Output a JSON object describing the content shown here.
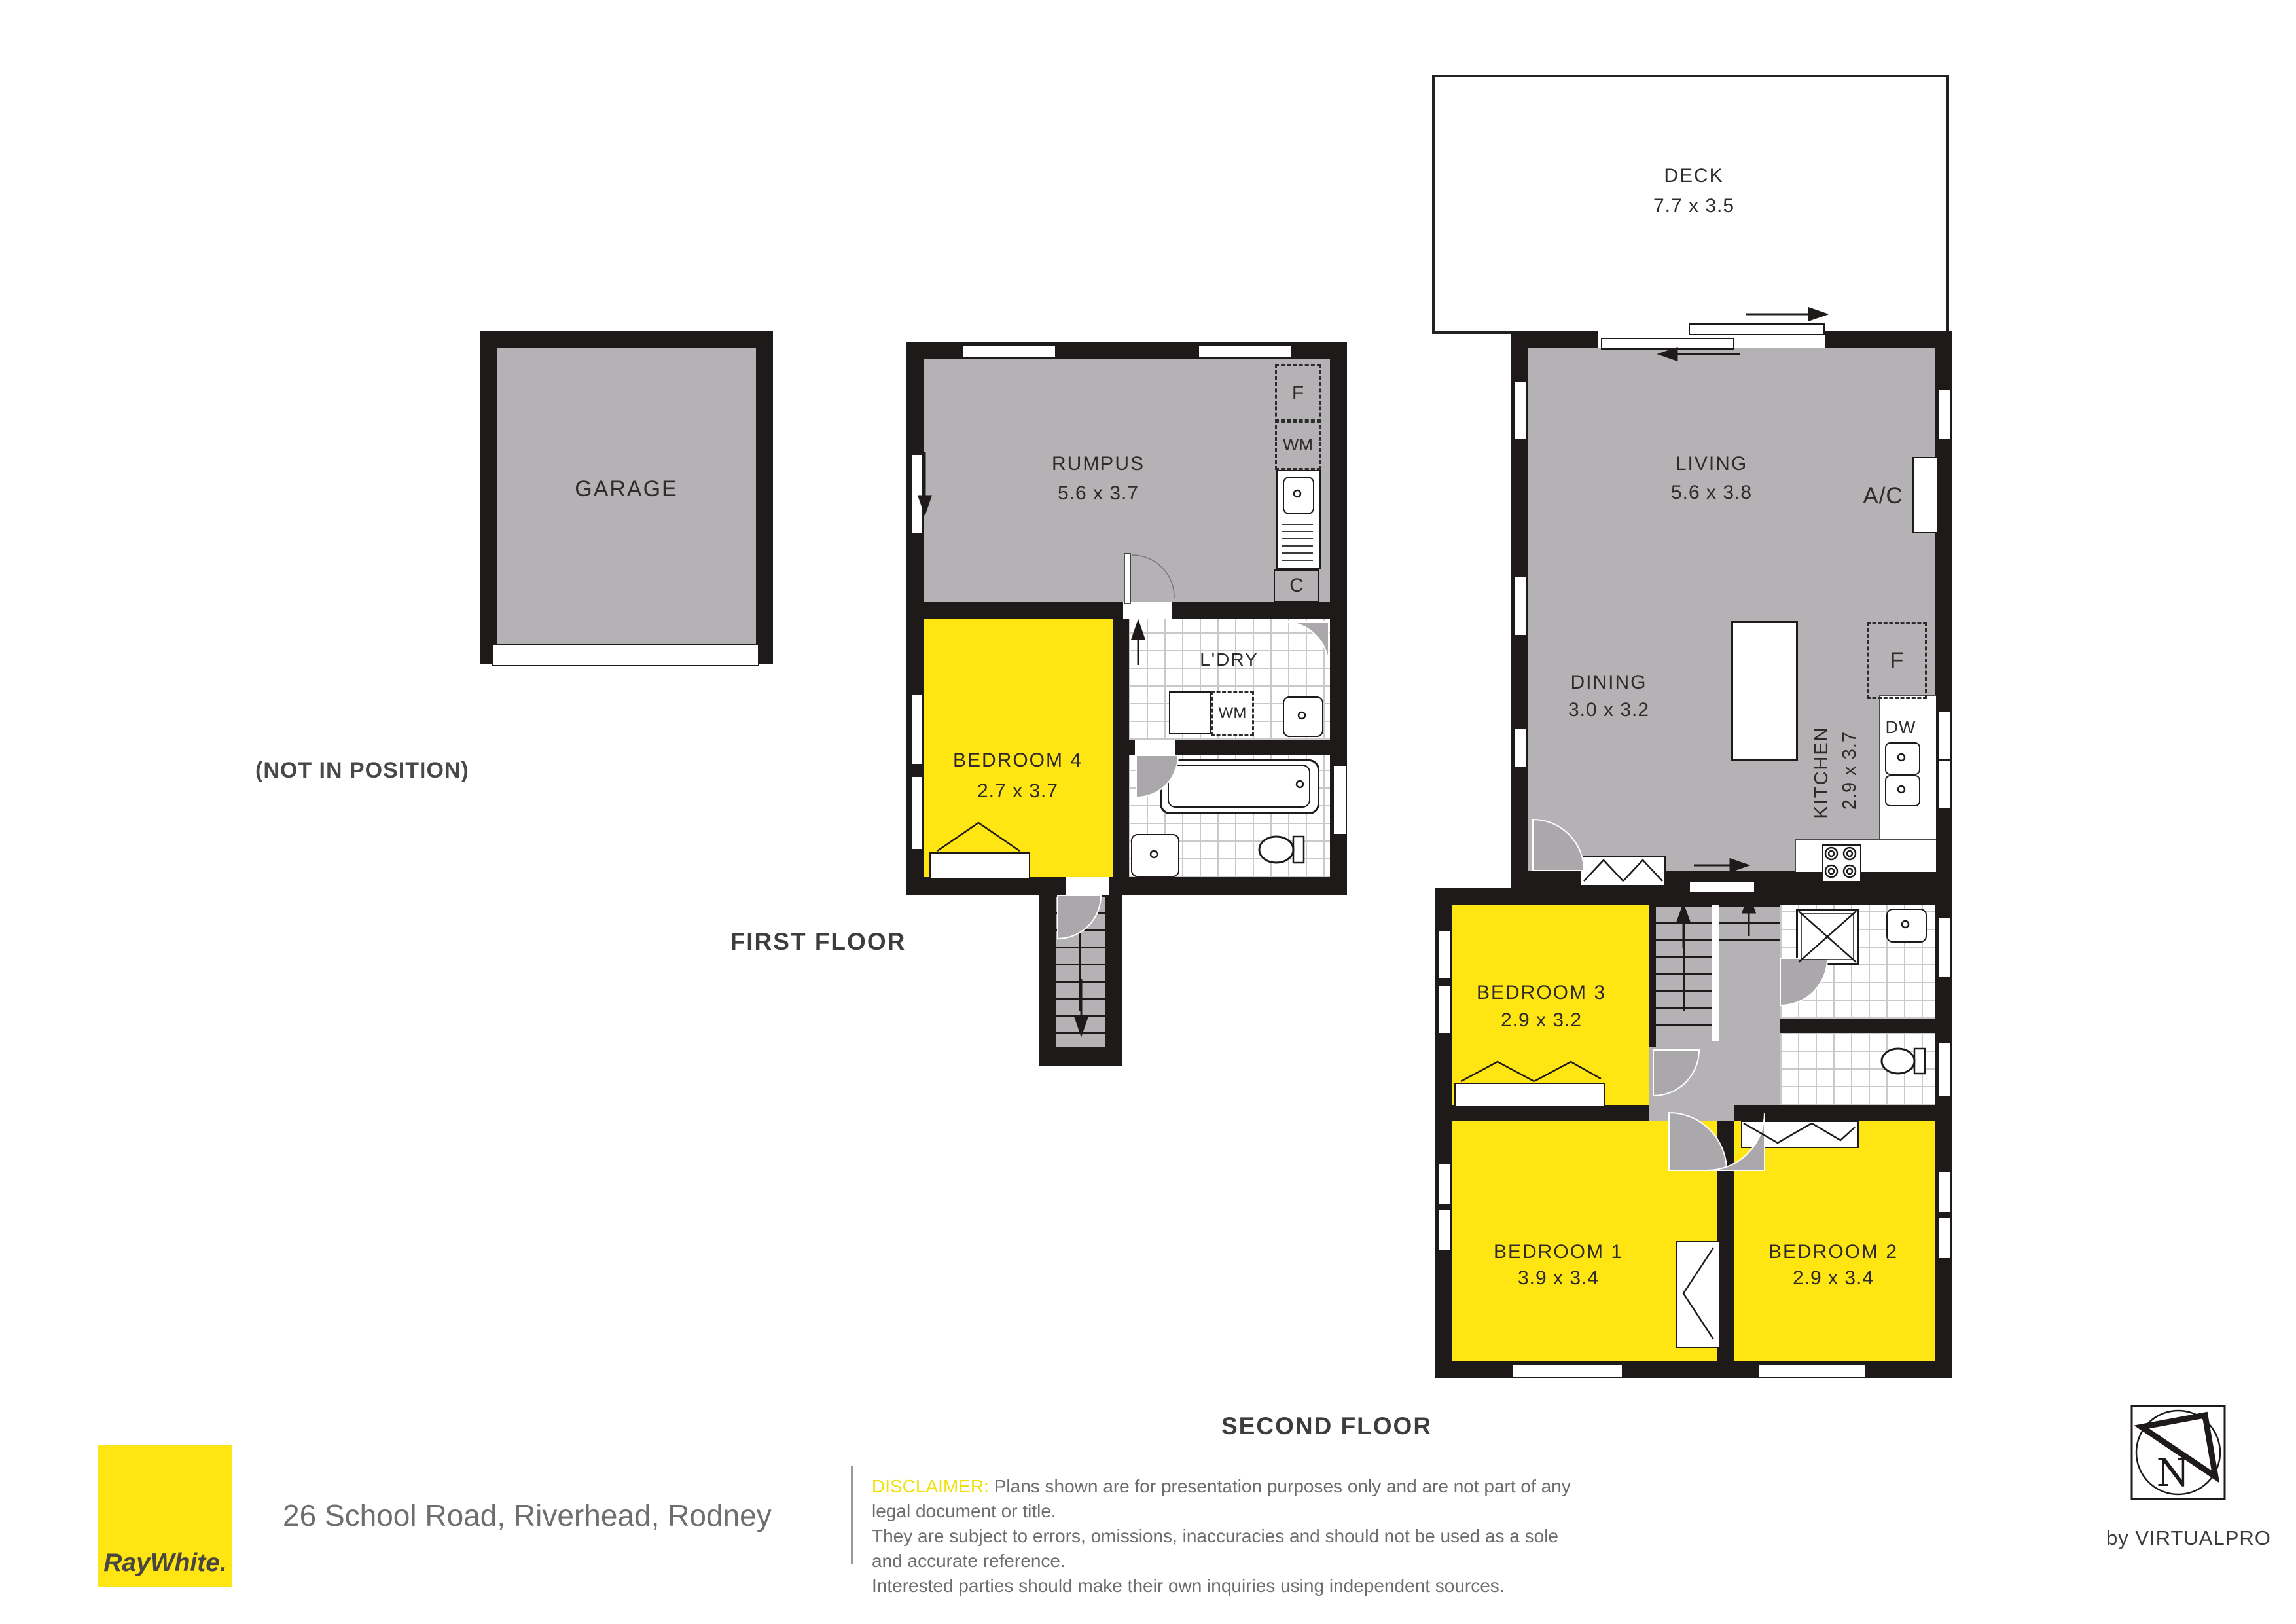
{
  "page": {
    "not_in_position": "(NOT IN POSITION)",
    "first_floor_title": "FIRST FLOOR",
    "second_floor_title": "SECOND FLOOR"
  },
  "garage": {
    "label": "GARAGE"
  },
  "first_floor": {
    "rumpus": {
      "name": "RUMPUS",
      "dims": "5.6 x 3.7"
    },
    "bedroom4": {
      "name": "BEDROOM 4",
      "dims": "2.7 x 3.7"
    },
    "laundry": {
      "name": "L'DRY"
    },
    "fridge": "F",
    "washer": "WM",
    "laundry_washer": "WM",
    "cupboard": "C"
  },
  "second_floor": {
    "deck": {
      "name": "DECK",
      "dims": "7.7 x 3.5"
    },
    "living": {
      "name": "LIVING",
      "dims": "5.6 x 3.8"
    },
    "dining": {
      "name": "DINING",
      "dims": "3.0 x 3.2"
    },
    "kitchen": {
      "name": "KITCHEN",
      "dims": "2.9 x 3.7"
    },
    "bedroom1": {
      "name": "BEDROOM 1",
      "dims": "3.9 x 3.4"
    },
    "bedroom2": {
      "name": "BEDROOM 2",
      "dims": "2.9 x 3.4"
    },
    "bedroom3": {
      "name": "BEDROOM 3",
      "dims": "2.9 x 3.2"
    },
    "ac": "A/C",
    "fridge": "F",
    "dishwasher": "DW"
  },
  "footer": {
    "brand": "RayWhite.",
    "address": "26 School Road, Riverhead, Rodney",
    "disclaimer_label": "DISCLAIMER:",
    "disclaimer_lines": [
      "Plans shown are for presentation purposes only and are not part of any legal document or title.",
      "They are subject to errors, omissions, inaccuracies and should not be used as a sole and accurate reference.",
      "Interested parties should make their own inquiries using independent sources."
    ],
    "credit": "by VIRTUALPRO",
    "north_letter": "N"
  },
  "colors": {
    "accent_yellow": "#FFE512",
    "room_gray": "#B4B2B5",
    "wall_black": "#1D1A19"
  }
}
